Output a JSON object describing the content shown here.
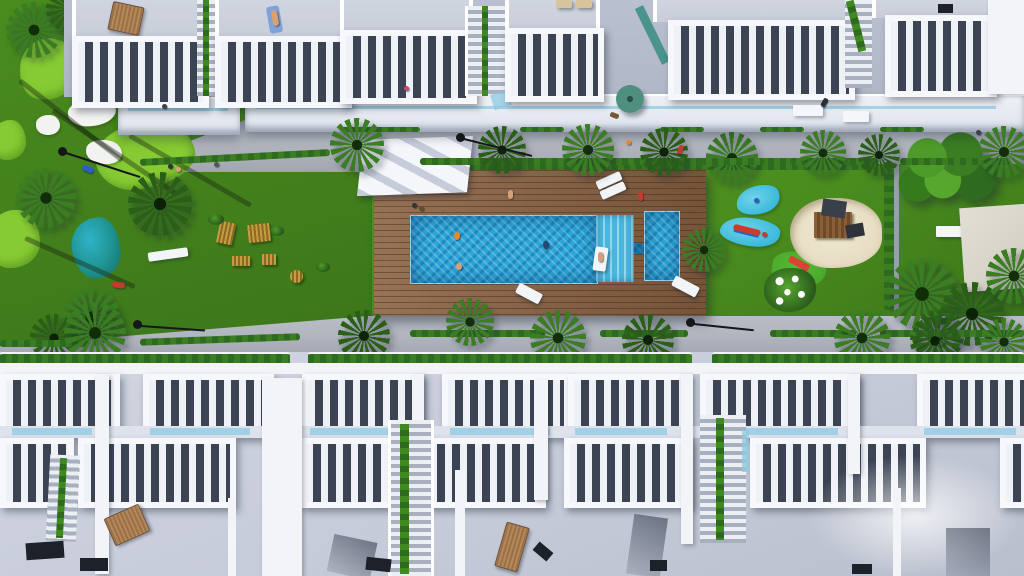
{
  "meta": {
    "image_type": "aerial-top-down-3d-render",
    "subject": "residential complex communal garden with pool",
    "contains_text": false
  },
  "palette": {
    "grass": "#4a8c1e",
    "grassDeep": "#3c761a",
    "golf": "#86cb33",
    "bunker": "#f2f3f1",
    "pond": "#1f9390",
    "deck": "#8a6243",
    "pool": "#2aa6d8",
    "poolLight": "#8fd8ee",
    "walkway": "#b2b6bf",
    "walkwayDeep": "#a2a6b0",
    "building": "#f2f4f8",
    "roof": "#c8cdd9",
    "roofDark": "#adb4c4",
    "slat": "#3c4454",
    "hedge": "#2e6b1f",
    "palm": "#3a7d22",
    "palmDark": "#2a5f18",
    "sand": "#e6dcc2",
    "playBlue": "#38b8da",
    "playGreen": "#4aa52c",
    "wood": "#9a7045",
    "lamp": "#15171a",
    "glass": "#8ec9e2",
    "parasol": "#4e8f7d",
    "bunkerSand": "#f2f3f1"
  },
  "scene": {
    "top_row_buildings": {
      "count": 6,
      "features": [
        "flat gray roof decks",
        "white slatted pergolas",
        "terrace promenade with glass balustrade",
        "stair accesses",
        "wooden sun lounger",
        "sunbathing person",
        "teal parasol"
      ]
    },
    "top_promenade": {
      "palm_trees": 7,
      "street_lamps": 2,
      "benches": 2,
      "hedge_planters": "segments along both edges",
      "figures": [
        "walker",
        "cyclist",
        "dog"
      ]
    },
    "garden_belt": {
      "golf_green": {
        "position": "top-left",
        "light_patches": 4,
        "sand_bunkers": 3
      },
      "pond": {
        "position": "left",
        "color": "teal"
      },
      "outdoor_gym": {
        "position": "left-centre",
        "equipment_pieces": 5
      },
      "pool_deck": {
        "material": "wood planks"
      },
      "main_pool": {
        "shape": "rectangle",
        "roman_steps": "right end",
        "swimmers": 3,
        "float_with_person": 1
      },
      "kids_pool": {
        "shape": "small rectangle",
        "link": "narrow channel"
      },
      "deck_loungers": 4,
      "playground": {
        "splash_mats": 2,
        "crocodile_toy": 1,
        "slide_mound": 1,
        "sand_pit": 1,
        "wooden_play_structure": 1,
        "flowering_bush": 1
      },
      "right_lawn": {
        "shade_tree": 1,
        "white_bench": 1,
        "petanque_pad": 1,
        "palm_cluster": 4,
        "hedge_divider": 1
      }
    },
    "bottom_promenade": {
      "palm_trees": 8,
      "street_lamps": 2,
      "hedge_planters": "segments"
    },
    "bottom_row_buildings": {
      "rows": 2,
      "features": [
        "white slatted pergolas",
        "glass balustrades",
        "planted staircases",
        "large roof decks",
        "wooden loungers",
        "chimneys"
      ]
    }
  }
}
